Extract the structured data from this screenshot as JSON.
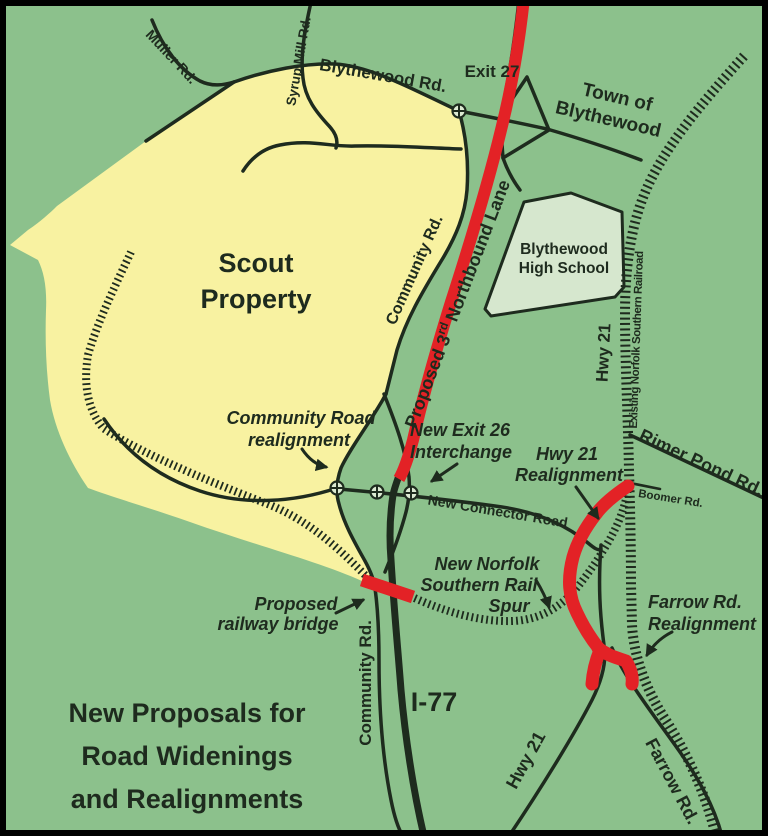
{
  "map": {
    "title": {
      "line1": "New Proposals for",
      "line2": "Road Widenings",
      "line3": "and Realignments"
    },
    "areas": {
      "scout": {
        "line1": "Scout",
        "line2": "Property"
      },
      "school": {
        "line1": "Blythewood",
        "line2": "High School"
      },
      "town": {
        "line1": "Town of",
        "line2": "Blythewood"
      }
    },
    "roads": {
      "muller": "Muller Rd.",
      "syrup_mill": "Syrup Mill Rd.",
      "blythewood_rd": "Blythewood Rd.",
      "exit27": "Exit 27",
      "community_north": "Community Rd.",
      "community_south": "Community Rd.",
      "hwy21_north": "Hwy 21",
      "hwy21_south": "Hwy 21",
      "railroad": "Existing Norfolk Southern Railroad",
      "rimer_pond": "Rimer Pond Rd.",
      "boomer": "Boomer Rd.",
      "farrow": "Farrow Rd.",
      "i77": "I-77",
      "connector": "New Connector Road",
      "proposed_lane": {
        "part1": "Proposed 3",
        "sup": "rd",
        "part2": "Northbound Lane"
      }
    },
    "annotations": {
      "community_realign": {
        "line1": "Community Road",
        "line2": "realignment"
      },
      "exit26": {
        "line1": "New Exit 26",
        "line2": "Interchange"
      },
      "hwy21_realign": {
        "line1": "Hwy 21",
        "line2": "Realignment"
      },
      "rail_spur": {
        "line1": "New Norfolk",
        "line2": "Southern Rail",
        "line3": "Spur"
      },
      "farrow_realign": {
        "line1": "Farrow Rd.",
        "line2": "Realignment"
      },
      "railway_bridge": {
        "line1": "Proposed",
        "line2": "railway bridge"
      }
    },
    "colors": {
      "background": "#8cc18c",
      "property": "#f8f2a1",
      "school": "#d6e7ce",
      "road": "#1e2b1e",
      "proposal_red": "#e32226",
      "text": "#1e2b1e",
      "border": "#000000"
    }
  }
}
